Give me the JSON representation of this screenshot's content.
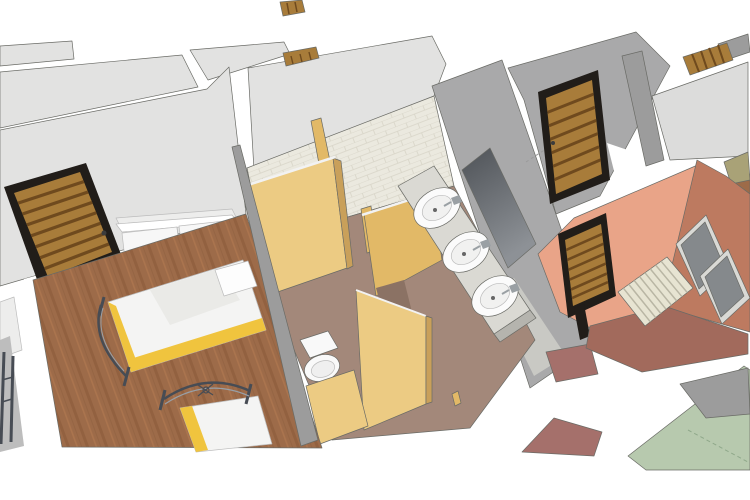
{
  "meta": {
    "title": "3D cutaway floor-plan rendering of a dormitory: bedroom with two beds, toilet stalls, washbasin area and shower room"
  },
  "palette": {
    "white": "#ffffff",
    "wall_light": "#e2e2e1",
    "wall_lighter": "#ededec",
    "wall_mid": "#a9a9aa",
    "wall_gray": "#9c9c9c",
    "gray_soft": "#bdbdbd",
    "floor_top_right": "#dcdcdb",
    "hall_tile": "#ccccc6",
    "tile_base": "#ebe9df",
    "tile_line": "#d7d4c7",
    "wood_base": "#9d6b49",
    "wood_dark": "#875838",
    "wood_light": "#b27a52",
    "door_wood": "#a87c3a",
    "door_slat": "#6f4a1e",
    "door_frame": "#211d19",
    "mauve_floor": "#a3887a",
    "taupe_dark": "#8b7264",
    "tan_light": "#eccb83",
    "tan_mid": "#e2b967",
    "tan_dark": "#c9a05a",
    "rail_white": "#f2f2f2",
    "toilet_white": "#f9f9f9",
    "toilet_inner": "#efefef",
    "counter": "#dad9d3",
    "counter_side": "#b5b4ae",
    "sink_white": "#fbfbfb",
    "sink_inner": "#f1f1f0",
    "chrome": "#9aa0a4",
    "drain": "#666666",
    "mirror_top": "#4e5257",
    "mirror_bottom": "#8d9196",
    "mirror_frame": "#d2d2d0",
    "salmon": "#e9a488",
    "terracotta": "#bd7a60",
    "brick_floor": "#a26a5c",
    "brick_light": "#a5706b",
    "panel_gray": "#85898c",
    "panel_frame": "#d9d9d5",
    "mat_base": "#e7e4d2",
    "mat_stripe": "#b9b6a4",
    "green_floor": "#b7c9ae",
    "green_line": "#8fa88a",
    "olive": "#a9a277",
    "dresser_white": "#f7f7f7",
    "handle_dark": "#3c3c3c",
    "bed_sheet": "#f4f4f3",
    "bed_shade": "#e2e2e0",
    "bed_yellow": "#f0c43e",
    "pillow": "#fdfdfd",
    "metal": "#474c54",
    "metal_light": "#98a0a8",
    "dash_gray": "#9a9a9a"
  },
  "scene": {
    "view": "bird's-eye cutaway 3D architectural render",
    "rooms": [
      {
        "name": "bedroom",
        "floor": "wood planks",
        "furniture": [
          "single bed with yellow-trim bedding",
          "second single bed",
          "white drawer dresser",
          "louvered wooden door"
        ]
      },
      {
        "name": "toilet-stalls",
        "partitions": "tan wooden panels with chrome rails",
        "fixtures": [
          "white toilet"
        ]
      },
      {
        "name": "washbasin-area",
        "fixtures": [
          "three oval basins on counter",
          "long wall mirror",
          "tiled wall"
        ]
      },
      {
        "name": "corridor",
        "fixtures": [
          "louvered wooden door"
        ]
      },
      {
        "name": "shower-room",
        "walls": "salmon and terracotta",
        "fixtures": [
          "louvered wooden door",
          "two gray wall panels",
          "slatted floor mat"
        ]
      },
      {
        "name": "adjacent-room-top-right",
        "floor": "light gray"
      },
      {
        "name": "room-bottom-right",
        "floor": "pale green"
      }
    ]
  }
}
